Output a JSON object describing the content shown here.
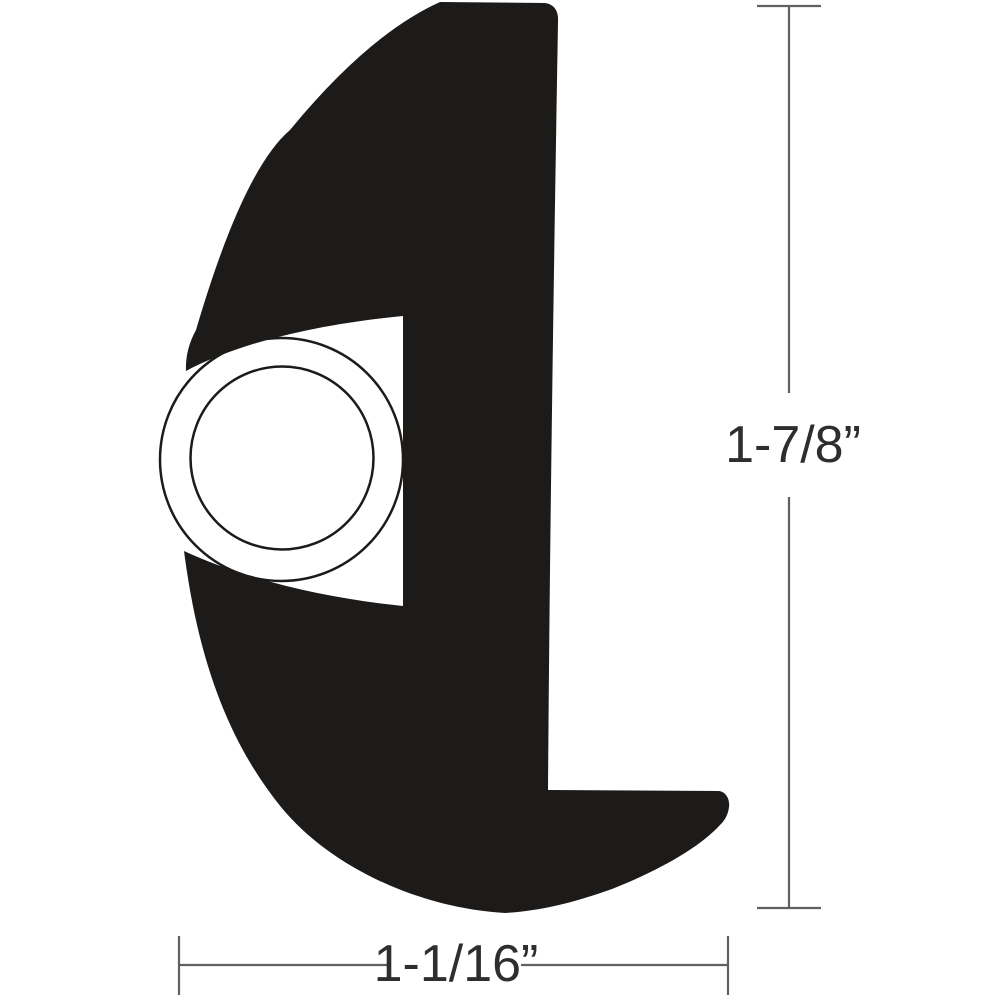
{
  "diagram": {
    "height_dimension": {
      "label": "1-7/8”"
    },
    "width_dimension": {
      "label": "1-1/16”"
    },
    "colors": {
      "background": "#ffffff",
      "profile": "#1d1b19",
      "dimension_line": "#606060",
      "label": "#2e2e2e"
    }
  }
}
